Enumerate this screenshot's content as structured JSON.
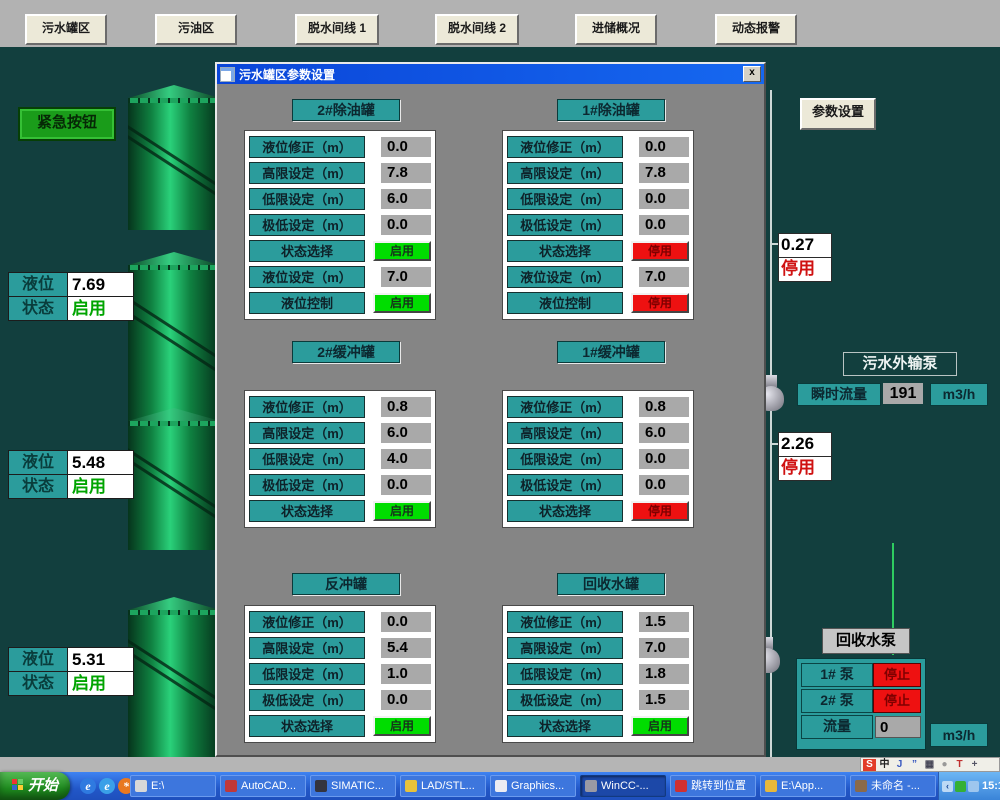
{
  "colors": {
    "bg_teal": "#123f3e",
    "accent_teal": "#2b9c9c",
    "status_on_green": "#00dd00",
    "status_off_red": "#ee1111",
    "title_blue": "#0a45d8",
    "button_beige": "#ece9d8",
    "taskbar_blue": "#2257c8"
  },
  "top_nav": {
    "buttons": [
      "污水罐区",
      "污油区",
      "脱水间线 1",
      "脱水间线 2",
      "进储概况",
      "动态报警"
    ]
  },
  "scene": {
    "emergency_label": "紧急按钮",
    "level_label": "液位",
    "status_label": "状态",
    "tanks": [
      {
        "level": "7.69",
        "status": "启用"
      },
      {
        "level": "5.48",
        "status": "启用"
      },
      {
        "level": "5.31",
        "status": "启用"
      }
    ]
  },
  "dialog": {
    "title": "污水罐区参数设置",
    "close_label": "x",
    "panels": [
      {
        "title": "2#除油罐",
        "rows": [
          {
            "label": "液位修正（m）",
            "value": "0.0"
          },
          {
            "label": "高限设定（m）",
            "value": "7.8"
          },
          {
            "label": "低限设定（m）",
            "value": "6.0"
          },
          {
            "label": "极低设定（m）",
            "value": "0.0"
          },
          {
            "label": "状态选择",
            "status": "启用",
            "state": "on"
          },
          {
            "label": "液位设定（m）",
            "value": "7.0"
          },
          {
            "label": "液位控制",
            "status": "启用",
            "state": "on"
          }
        ]
      },
      {
        "title": "1#除油罐",
        "rows": [
          {
            "label": "液位修正（m）",
            "value": "0.0"
          },
          {
            "label": "高限设定（m）",
            "value": "7.8"
          },
          {
            "label": "低限设定（m）",
            "value": "0.0"
          },
          {
            "label": "极低设定（m）",
            "value": "0.0"
          },
          {
            "label": "状态选择",
            "status": "停用",
            "state": "off"
          },
          {
            "label": "液位设定（m）",
            "value": "7.0"
          },
          {
            "label": "液位控制",
            "status": "停用",
            "state": "off"
          }
        ]
      },
      {
        "title": "2#缓冲罐",
        "rows": [
          {
            "label": "液位修正（m）",
            "value": "0.8"
          },
          {
            "label": "高限设定（m）",
            "value": "6.0"
          },
          {
            "label": "低限设定（m）",
            "value": "4.0"
          },
          {
            "label": "极低设定（m）",
            "value": "0.0"
          },
          {
            "label": "状态选择",
            "status": "启用",
            "state": "on"
          }
        ]
      },
      {
        "title": "1#缓冲罐",
        "rows": [
          {
            "label": "液位修正（m）",
            "value": "0.8"
          },
          {
            "label": "高限设定（m）",
            "value": "6.0"
          },
          {
            "label": "低限设定（m）",
            "value": "0.0"
          },
          {
            "label": "极低设定（m）",
            "value": "0.0"
          },
          {
            "label": "状态选择",
            "status": "停用",
            "state": "off"
          }
        ]
      },
      {
        "title": "反冲罐",
        "rows": [
          {
            "label": "液位修正（m）",
            "value": "0.0"
          },
          {
            "label": "高限设定（m）",
            "value": "5.4"
          },
          {
            "label": "低限设定（m）",
            "value": "1.0"
          },
          {
            "label": "极低设定（m）",
            "value": "0.0"
          },
          {
            "label": "状态选择",
            "status": "启用",
            "state": "on"
          }
        ]
      },
      {
        "title": "回收水罐",
        "rows": [
          {
            "label": "液位修正（m）",
            "value": "1.5"
          },
          {
            "label": "高限设定（m）",
            "value": "7.0"
          },
          {
            "label": "低限设定（m）",
            "value": "1.8"
          },
          {
            "label": "极低设定（m）",
            "value": "1.5"
          },
          {
            "label": "状态选择",
            "status": "启用",
            "state": "on"
          }
        ]
      }
    ]
  },
  "right_panel": {
    "settings_button_label": "参数设置",
    "readout_top": {
      "value": "0.27",
      "status": "停用"
    },
    "readout_mid": {
      "value": "2.26",
      "status": "停用"
    },
    "export_pump": {
      "title": "污水外输泵",
      "flow_label": "瞬时流量",
      "flow_value": "191",
      "flow_unit": "m3/h"
    },
    "recycle_pump": {
      "title": "回收水泵",
      "unit": "m3/h",
      "rows": [
        {
          "label": "1# 泵",
          "status": "停止"
        },
        {
          "label": "2# 泵",
          "status": "停止"
        },
        {
          "label": "流量",
          "value": "0"
        }
      ]
    }
  },
  "taskbar": {
    "start_label": "开始",
    "quick_launch": [
      {
        "name": "ie-icon",
        "glyph": "e",
        "bg": "#2f7ae0"
      },
      {
        "name": "browser-icon",
        "glyph": "e",
        "bg": "#3aa0e8"
      },
      {
        "name": "media-icon",
        "glyph": "*",
        "bg": "#e87820"
      }
    ],
    "items": [
      {
        "label": "E:\\",
        "icon": "#d8d8d8"
      },
      {
        "label": "AutoCAD...",
        "icon": "#c03838"
      },
      {
        "label": "SIMATIC...",
        "icon": "#34343e"
      },
      {
        "label": "LAD/STL...",
        "icon": "#e8c23a"
      },
      {
        "label": "Graphics...",
        "icon": "#ececf2"
      },
      {
        "label": "WinCC-...",
        "icon": "#9a9aa4",
        "active": true
      },
      {
        "label": "跳转到位置",
        "icon": "#d03030"
      },
      {
        "label": "E:\\App...",
        "icon": "#e8b83a"
      },
      {
        "label": "未命名 -...",
        "icon": "#8a6a4a"
      }
    ],
    "tray_icons": [
      {
        "name": "hide-icons-chevron",
        "glyph": "‹",
        "bg": "#bcd9f5",
        "fg": "#1a4a9a"
      },
      {
        "name": "antivirus-shield-icon",
        "glyph": "",
        "bg": "#35b035"
      },
      {
        "name": "network-icon",
        "glyph": "",
        "bg": "#9ec6ee"
      }
    ],
    "clock": "15:10",
    "ime_bar": [
      {
        "name": "sogou-icon",
        "glyph": "S",
        "bg": "#e23c28",
        "fg": "#ffffff"
      },
      {
        "name": "chinese-mode-icon",
        "glyph": "中",
        "bg": "",
        "fg": "#222222"
      },
      {
        "name": "fullhalf-icon",
        "glyph": "J",
        "bg": "",
        "fg": "#3a5ac0"
      },
      {
        "name": "punctuation-icon",
        "glyph": "”",
        "bg": "",
        "fg": "#3a5ac0"
      },
      {
        "name": "keyboard-icon",
        "glyph": "▦",
        "bg": "",
        "fg": "#445"
      },
      {
        "name": "user-icon",
        "glyph": "●",
        "bg": "",
        "fg": "#999999"
      },
      {
        "name": "skin-icon",
        "glyph": "T",
        "bg": "",
        "fg": "#c03030"
      },
      {
        "name": "tools-icon",
        "glyph": "+",
        "bg": "",
        "fg": "#556"
      }
    ]
  }
}
